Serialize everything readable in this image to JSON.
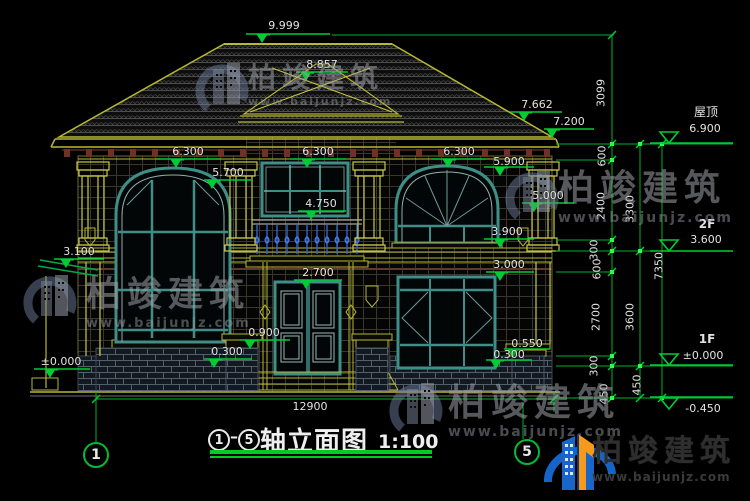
{
  "title": {
    "axis_start": "1",
    "axis_end": "5",
    "dash": "—",
    "name": "轴立面图",
    "scale": "1:100"
  },
  "axis_bubbles": [
    {
      "id": "axis-1",
      "label": "1"
    },
    {
      "id": "axis-5",
      "label": "5"
    }
  ],
  "colors": {
    "dim_green": "#00cc33",
    "text_white": "#e2e2e2",
    "line_yellow": "#b8b832",
    "window_teal": "#3f8f88",
    "baluster_blue": "#2f63d8",
    "brand_blue": "#1565c8",
    "brand_orange": "#f59a1a"
  },
  "markers": [
    {
      "id": "peak",
      "label": "9.999",
      "cx": 284,
      "ty": 20,
      "x1": 246,
      "x2": 330,
      "ly": 34,
      "tx": 262,
      "k": "f"
    },
    {
      "id": "tower-peak",
      "label": "8.857",
      "cx": 322,
      "ty": 59,
      "x1": 296,
      "x2": 348,
      "ly": 72,
      "tx": 306,
      "k": "f"
    },
    {
      "id": "eave-upper",
      "label": "7.662",
      "cx": 537,
      "ty": 99,
      "x1": 510,
      "x2": 562,
      "ly": 112,
      "tx": 524,
      "k": "f"
    },
    {
      "id": "eave-main",
      "label": "7.200",
      "cx": 569,
      "ty": 116,
      "x1": 544,
      "x2": 594,
      "ly": 129,
      "tx": 552,
      "k": "f"
    },
    {
      "id": "lv6300-left",
      "label": "6.300",
      "cx": 188,
      "ty": 146,
      "x1": 156,
      "x2": 220,
      "ly": 159,
      "tx": 176,
      "k": "f"
    },
    {
      "id": "lv6300-mid",
      "label": "6.300",
      "cx": 318,
      "ty": 146,
      "x1": 290,
      "x2": 346,
      "ly": 159,
      "tx": 307,
      "k": "f"
    },
    {
      "id": "lv6300-right",
      "label": "6.300",
      "cx": 459,
      "ty": 146,
      "x1": 432,
      "x2": 486,
      "ly": 159,
      "tx": 448,
      "k": "f"
    },
    {
      "id": "lv5900",
      "label": "5.900",
      "cx": 509,
      "ty": 156,
      "x1": 484,
      "x2": 534,
      "ly": 167,
      "tx": 500,
      "k": "f"
    },
    {
      "id": "lv5700",
      "label": "5.700",
      "cx": 228,
      "ty": 167,
      "x1": 204,
      "x2": 252,
      "ly": 180,
      "tx": 212,
      "k": "f"
    },
    {
      "id": "lv5000",
      "label": "5.000",
      "cx": 548,
      "ty": 190,
      "x1": 522,
      "x2": 574,
      "ly": 203,
      "tx": 534,
      "k": "f"
    },
    {
      "id": "lv4750",
      "label": "4.750",
      "cx": 321,
      "ty": 198,
      "x1": 298,
      "x2": 346,
      "ly": 211,
      "tx": 311,
      "k": "f"
    },
    {
      "id": "lv3900",
      "label": "3.900",
      "cx": 507,
      "ty": 226,
      "x1": 484,
      "x2": 534,
      "ly": 239,
      "tx": 500,
      "k": "f"
    },
    {
      "id": "lv3100",
      "label": "3.100",
      "cx": 79,
      "ty": 246,
      "x1": 54,
      "x2": 104,
      "ly": 259,
      "tx": 66,
      "k": "f"
    },
    {
      "id": "lv3000",
      "label": "3.000",
      "cx": 509,
      "ty": 259,
      "x1": 486,
      "x2": 534,
      "ly": 272,
      "tx": 500,
      "k": "f"
    },
    {
      "id": "lv2700",
      "label": "2.700",
      "cx": 318,
      "ty": 267,
      "x1": 294,
      "x2": 342,
      "ly": 280,
      "tx": 306,
      "k": "f"
    },
    {
      "id": "lv0900",
      "label": "0.900",
      "cx": 264,
      "ty": 327,
      "x1": 240,
      "x2": 290,
      "ly": 340,
      "tx": 250,
      "k": "f"
    },
    {
      "id": "lv0300-door",
      "label": "0.300",
      "cx": 227,
      "ty": 346,
      "x1": 204,
      "x2": 252,
      "ly": 359,
      "tx": 214,
      "k": "f"
    },
    {
      "id": "lv0550",
      "label": "0.550",
      "cx": 527,
      "ty": 338,
      "x1": 504,
      "x2": 550,
      "ly": 349,
      "tx": 513,
      "k": "f"
    },
    {
      "id": "lv0300-right",
      "label": "0.300",
      "cx": 509,
      "ty": 349,
      "x1": 486,
      "x2": 532,
      "ly": 360,
      "tx": 496,
      "k": "f"
    },
    {
      "id": "lv-zero-left",
      "label": "±0.000",
      "cx": 61,
      "ty": 356,
      "x1": 34,
      "x2": 90,
      "ly": 369,
      "tx": 50,
      "k": "f"
    },
    {
      "id": "roof-level",
      "label": "6.900",
      "cx": 705,
      "ty": 123,
      "x1": 650,
      "x2": 733,
      "ly": 143,
      "tx": 669,
      "k": "o"
    },
    {
      "id": "f2-level",
      "label": "3.600",
      "cx": 706,
      "ty": 234,
      "x1": 650,
      "x2": 733,
      "ly": 251,
      "tx": 669,
      "k": "o"
    },
    {
      "id": "f1-level",
      "label": "±0.000",
      "cx": 703,
      "ty": 350,
      "x1": 650,
      "x2": 733,
      "ly": 365,
      "tx": 669,
      "k": "o"
    },
    {
      "id": "ground-level",
      "label": "-0.450",
      "cx": 703,
      "ty": 403,
      "x1": 650,
      "x2": 733,
      "ly": 397,
      "tx": 669,
      "k": "o",
      "flip": true
    }
  ],
  "texts": [
    {
      "id": "roof-name",
      "label": "屋顶",
      "cx": 706,
      "ty": 106,
      "cls": "cjk"
    },
    {
      "id": "floor-2f",
      "label": "2F",
      "cx": 707,
      "ty": 218,
      "cls": "bold"
    },
    {
      "id": "floor-1f",
      "label": "1F",
      "cx": 707,
      "ty": 333,
      "cls": "bold"
    }
  ],
  "vdims": [
    {
      "id": "d3099",
      "label": "3099",
      "x": 601,
      "y": 93
    },
    {
      "id": "d600a",
      "label": "600",
      "x": 602,
      "y": 156
    },
    {
      "id": "d2400",
      "label": "2400",
      "x": 601,
      "y": 206
    },
    {
      "id": "d300a",
      "label": "300",
      "x": 594,
      "y": 250
    },
    {
      "id": "d600b",
      "label": "600",
      "x": 597,
      "y": 269
    },
    {
      "id": "d2700",
      "label": "2700",
      "x": 596,
      "y": 317
    },
    {
      "id": "d300b",
      "label": "300",
      "x": 594,
      "y": 366
    },
    {
      "id": "d450a",
      "label": "450",
      "x": 604,
      "y": 394
    },
    {
      "id": "d3300",
      "label": "3300",
      "x": 630,
      "y": 209
    },
    {
      "id": "d3600",
      "label": "3600",
      "x": 630,
      "y": 317
    },
    {
      "id": "d450b",
      "label": "450",
      "x": 637,
      "y": 385
    },
    {
      "id": "d7350",
      "label": "7350",
      "x": 659,
      "y": 266
    }
  ],
  "bottom_dim": {
    "label": "12900",
    "cx": 310,
    "ty": 401
  },
  "watermark": {
    "brand": "柏竣建筑",
    "url": "www.baijunjz.com",
    "instances": [
      {
        "x": 248,
        "y": 64,
        "size": 28,
        "usize": 11
      },
      {
        "x": 558,
        "y": 171,
        "size": 36,
        "usize": 14
      },
      {
        "x": 86,
        "y": 278,
        "size": 35,
        "usize": 13
      },
      {
        "x": 448,
        "y": 384,
        "size": 37,
        "usize": 14
      }
    ]
  },
  "footer_logo": {
    "brand": "柏竣建筑",
    "url": "www.baijunjz.com"
  }
}
